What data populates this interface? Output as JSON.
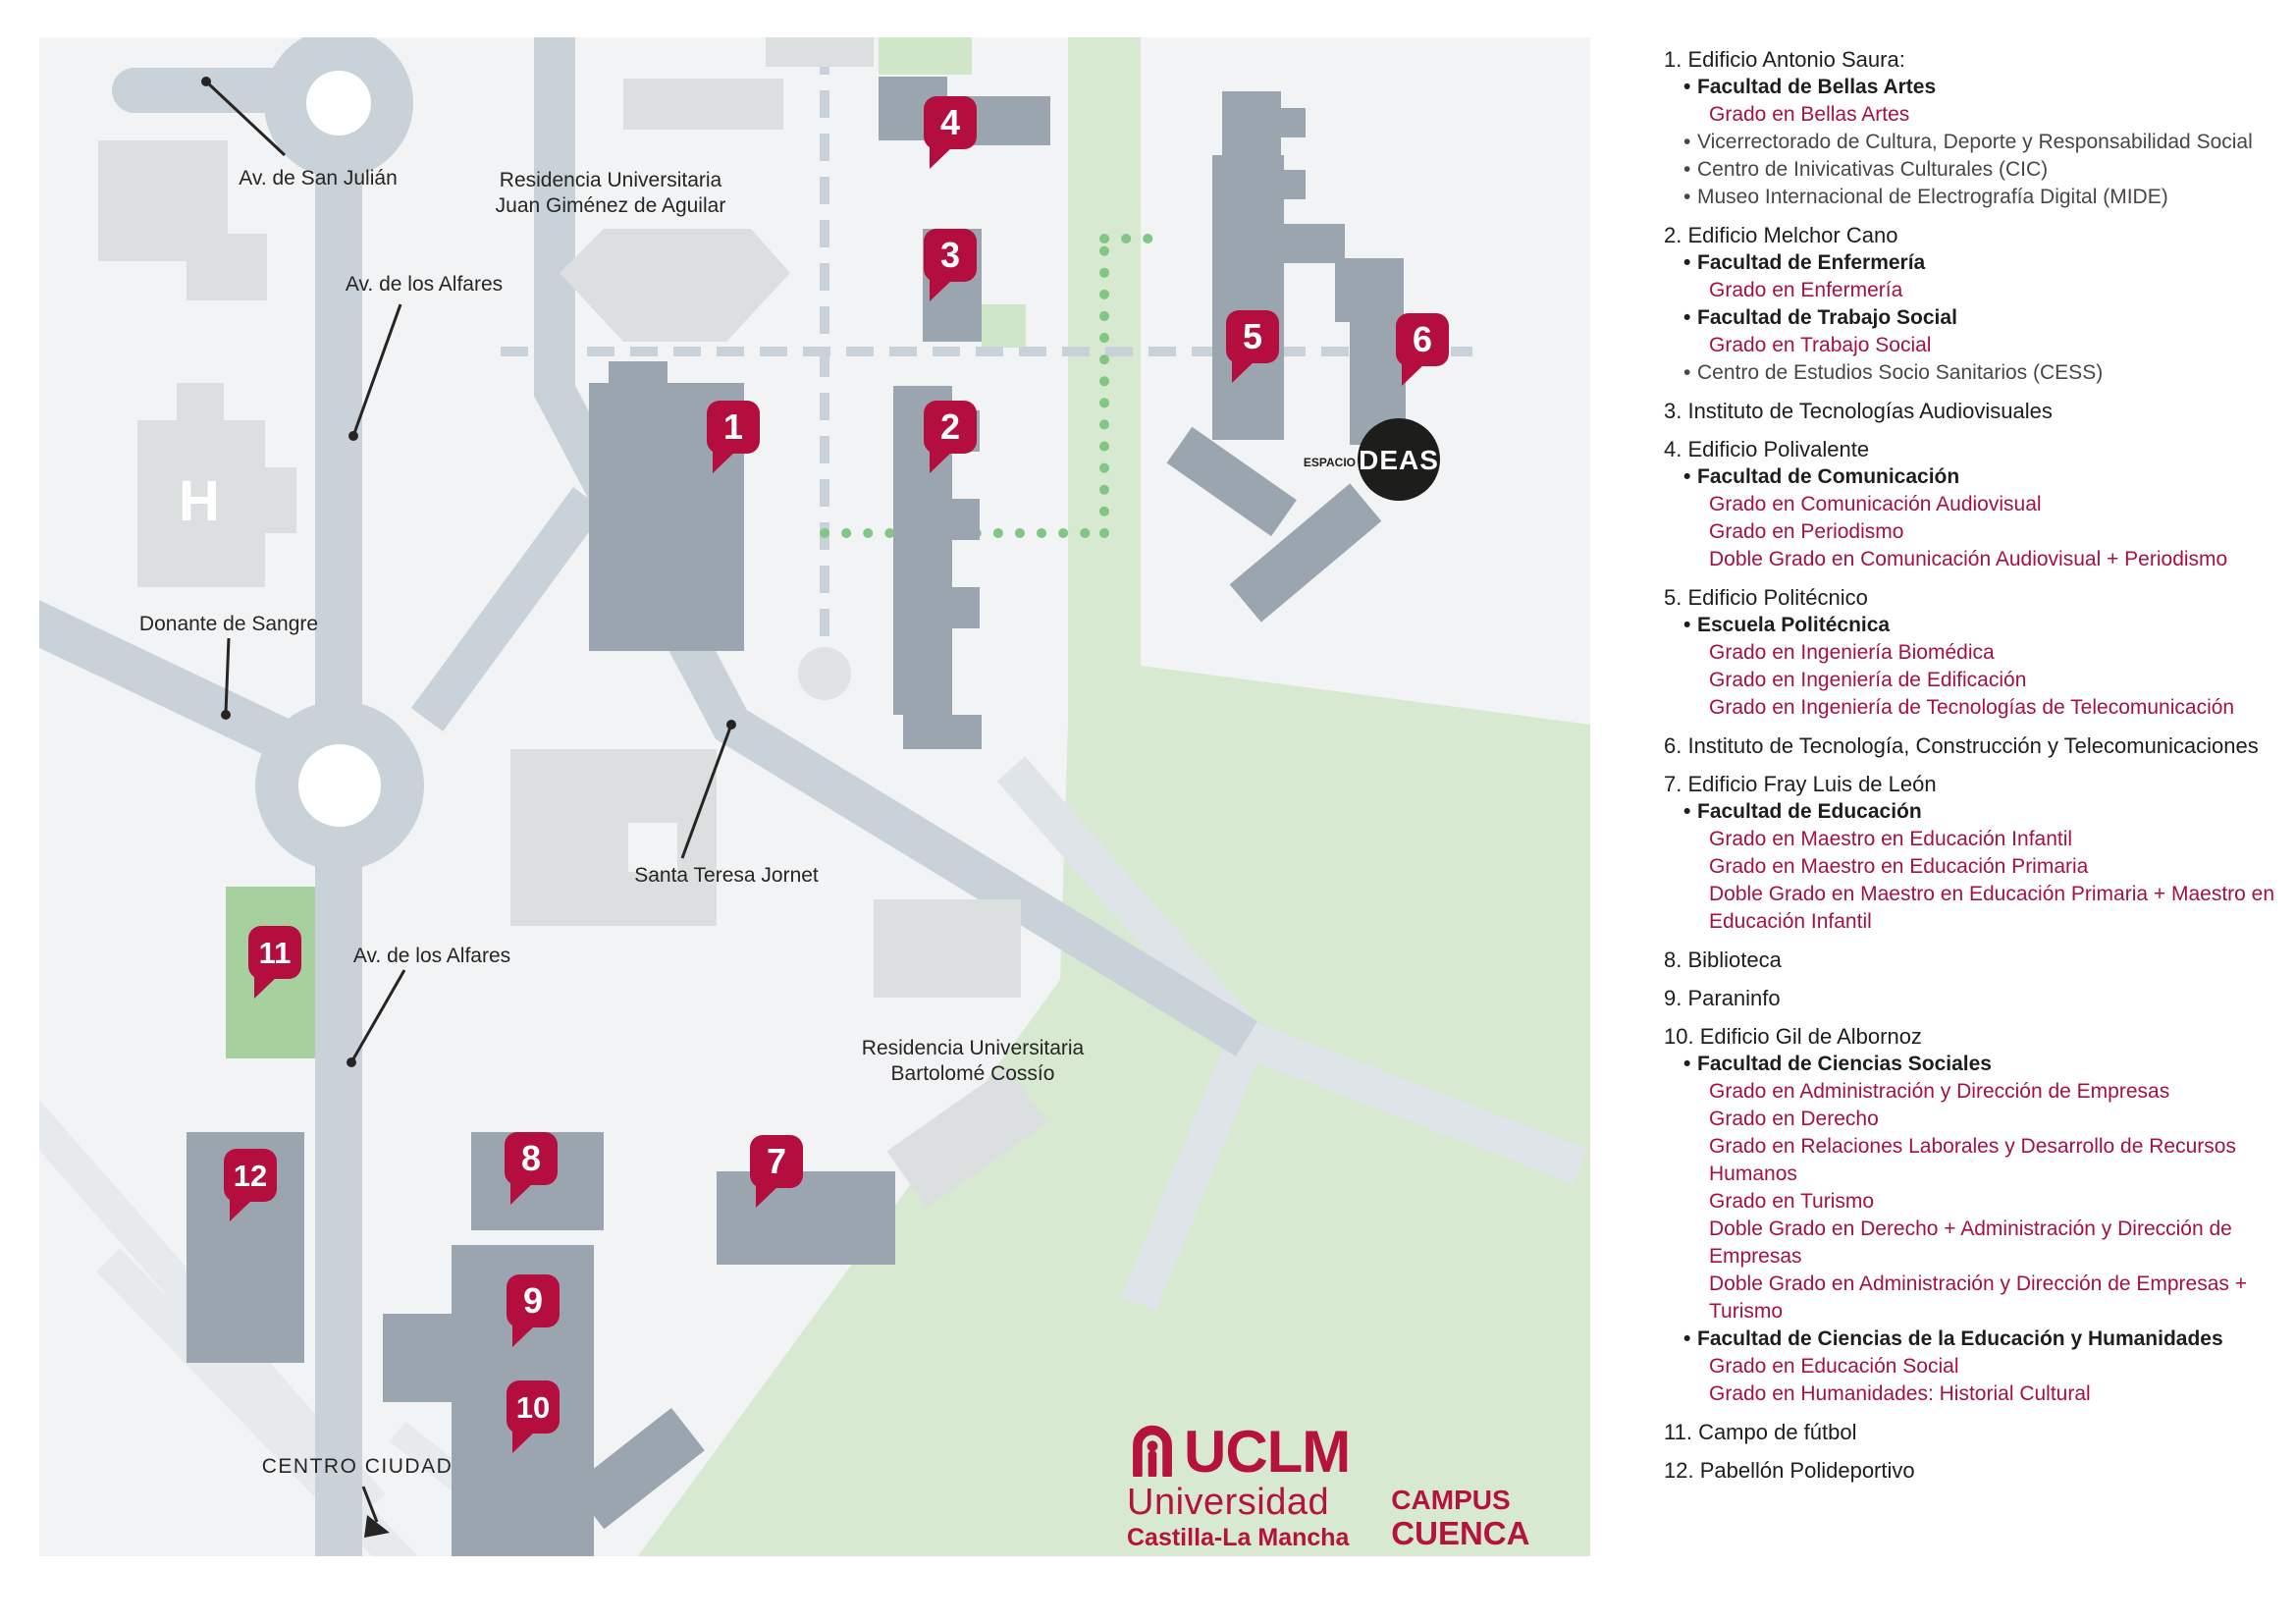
{
  "map": {
    "labels": {
      "av_san_julian": "Av. de San Julián",
      "av_alfares": "Av. de los Alfares",
      "donante": "Donante de Sangre",
      "residencia_juan_1": "Residencia Universitaria",
      "residencia_juan_2": "Juan Giménez de Aguilar",
      "santa_teresa": "Santa Teresa Jornet",
      "residencia_bart_1": "Residencia Universitaria",
      "residencia_bart_2": "Bartolomé Cossío",
      "centro_ciudad": "CENTRO CIUDAD",
      "hospital_h": "H",
      "espacio": "ESPACIO",
      "ideas": "DEAS"
    },
    "markers": [
      "1",
      "2",
      "3",
      "4",
      "5",
      "6",
      "7",
      "8",
      "9",
      "10",
      "11",
      "12"
    ]
  },
  "legend": {
    "items": [
      {
        "number": "1",
        "title": "Edificio Antonio Saura:",
        "subitems": [
          {
            "text": "Facultad de Bellas Artes",
            "style": "bold"
          },
          {
            "text": "Grado en Bellas Artes",
            "style": "red"
          },
          {
            "text": "Vicerrectorado de Cultura, Deporte y Responsabilidad Social",
            "style": "plain"
          },
          {
            "text": "Centro de Inivicativas Culturales (CIC)",
            "style": "plain"
          },
          {
            "text": "Museo Internacional de Electrografía Digital (MIDE)",
            "style": "plain"
          }
        ]
      },
      {
        "number": "2",
        "title": "Edificio Melchor Cano",
        "subitems": [
          {
            "text": "Facultad de Enfermería",
            "style": "bold"
          },
          {
            "text": "Grado en Enfermería",
            "style": "red"
          },
          {
            "text": "Facultad de Trabajo Social",
            "style": "bold"
          },
          {
            "text": "Grado en Trabajo Social",
            "style": "red"
          },
          {
            "text": "Centro de Estudios Socio Sanitarios (CESS)",
            "style": "plain"
          }
        ]
      },
      {
        "number": "3",
        "title": "Instituto de Tecnologías Audiovisuales",
        "subitems": []
      },
      {
        "number": "4",
        "title": "Edificio Polivalente",
        "subitems": [
          {
            "text": "Facultad de Comunicación",
            "style": "bold"
          },
          {
            "text": "Grado en Comunicación Audiovisual",
            "style": "red"
          },
          {
            "text": "Grado en Periodismo",
            "style": "red"
          },
          {
            "text": "Doble Grado en Comunicación Audiovisual + Periodismo",
            "style": "red"
          }
        ]
      },
      {
        "number": "5",
        "title": "Edificio Politécnico",
        "subitems": [
          {
            "text": "Escuela Politécnica",
            "style": "bold"
          },
          {
            "text": "Grado en Ingeniería Biomédica",
            "style": "red"
          },
          {
            "text": "Grado en Ingeniería de Edificación",
            "style": "red"
          },
          {
            "text": "Grado en Ingeniería de Tecnologías de Telecomunicación",
            "style": "red"
          }
        ]
      },
      {
        "number": "6",
        "title": "Instituto de Tecnología, Construcción y Telecomunicaciones",
        "subitems": []
      },
      {
        "number": "7",
        "title": "Edificio Fray Luis de León",
        "subitems": [
          {
            "text": "Facultad de Educación",
            "style": "bold"
          },
          {
            "text": "Grado en Maestro en Educación Infantil",
            "style": "red"
          },
          {
            "text": "Grado en Maestro en Educación Primaria",
            "style": "red"
          },
          {
            "text": "Doble Grado en Maestro en Educación Primaria + Maestro en Educación Infantil",
            "style": "red"
          }
        ]
      },
      {
        "number": "8",
        "title": "Biblioteca",
        "subitems": []
      },
      {
        "number": "9",
        "title": "Paraninfo",
        "subitems": []
      },
      {
        "number": "10",
        "title": "Edificio Gil de Albornoz",
        "subitems": [
          {
            "text": "Facultad de Ciencias Sociales",
            "style": "bold"
          },
          {
            "text": "Grado en Administración y Dirección de Empresas",
            "style": "red"
          },
          {
            "text": "Grado en Derecho",
            "style": "red"
          },
          {
            "text": "Grado en Relaciones Laborales y Desarrollo de Recursos Humanos",
            "style": "red"
          },
          {
            "text": "Grado en Turismo",
            "style": "red"
          },
          {
            "text": "Doble Grado en Derecho + Administración y Dirección de Empresas",
            "style": "red"
          },
          {
            "text": "Doble Grado en Administración y Dirección de Empresas + Turismo",
            "style": "red"
          },
          {
            "text": "Facultad de Ciencias de la Educación y Humanidades",
            "style": "bold"
          },
          {
            "text": "Grado en Educación Social",
            "style": "red"
          },
          {
            "text": "Grado en Humanidades: Historial Cultural",
            "style": "red"
          }
        ]
      },
      {
        "number": "11",
        "title": "Campo de fútbol",
        "subitems": []
      },
      {
        "number": "12",
        "title": "Pabellón Polideportivo",
        "subitems": []
      }
    ]
  },
  "logo": {
    "uclm": "UCLM",
    "universidad": "Universidad",
    "castilla": "Castilla-La Mancha",
    "campus": "CAMPUS",
    "cuenca": "CUENCA"
  },
  "colors": {
    "marker_red": "#b30e3e",
    "degree_red": "#a51140",
    "brand_red": "#b5123e",
    "road_gray": "#c9d2d9",
    "building_dark": "#9aa5b0",
    "building_light": "#dcdfe0",
    "green_light": "#d7e9d0",
    "green_field": "#a6d19f",
    "map_bg": "#f2f3f4"
  }
}
